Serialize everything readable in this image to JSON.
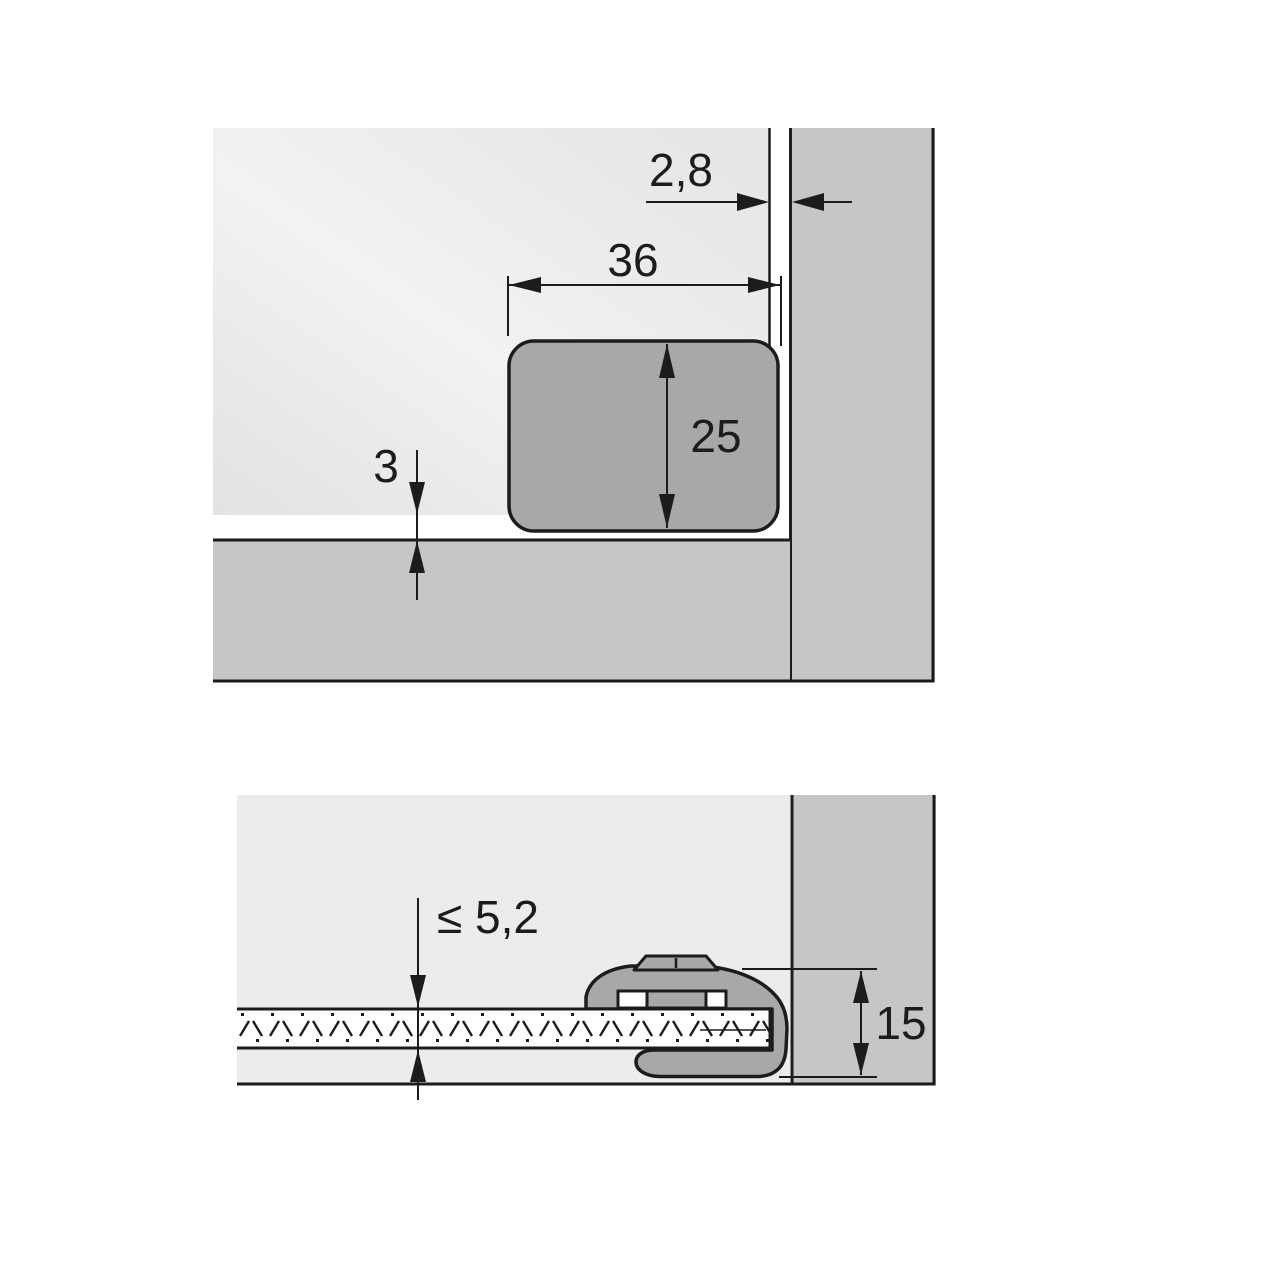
{
  "colors": {
    "canvas_background": "#ffffff",
    "door_panel": "#e9e9e9",
    "cabinet_panel": "#c6c6c6",
    "mounting_plate": "#a8a8a8",
    "clamp_body": "#a8a8a8",
    "glass": "#ffffff",
    "line": "#1c1c1c"
  },
  "top_view": {
    "dim_door_side_gap": "2,8",
    "dim_plate_width": "36",
    "dim_plate_height": "25",
    "dim_door_bottom_gap": "3"
  },
  "cross_section": {
    "dim_glass_thickness": "≤ 5,2",
    "dim_clamp_height": "15"
  }
}
